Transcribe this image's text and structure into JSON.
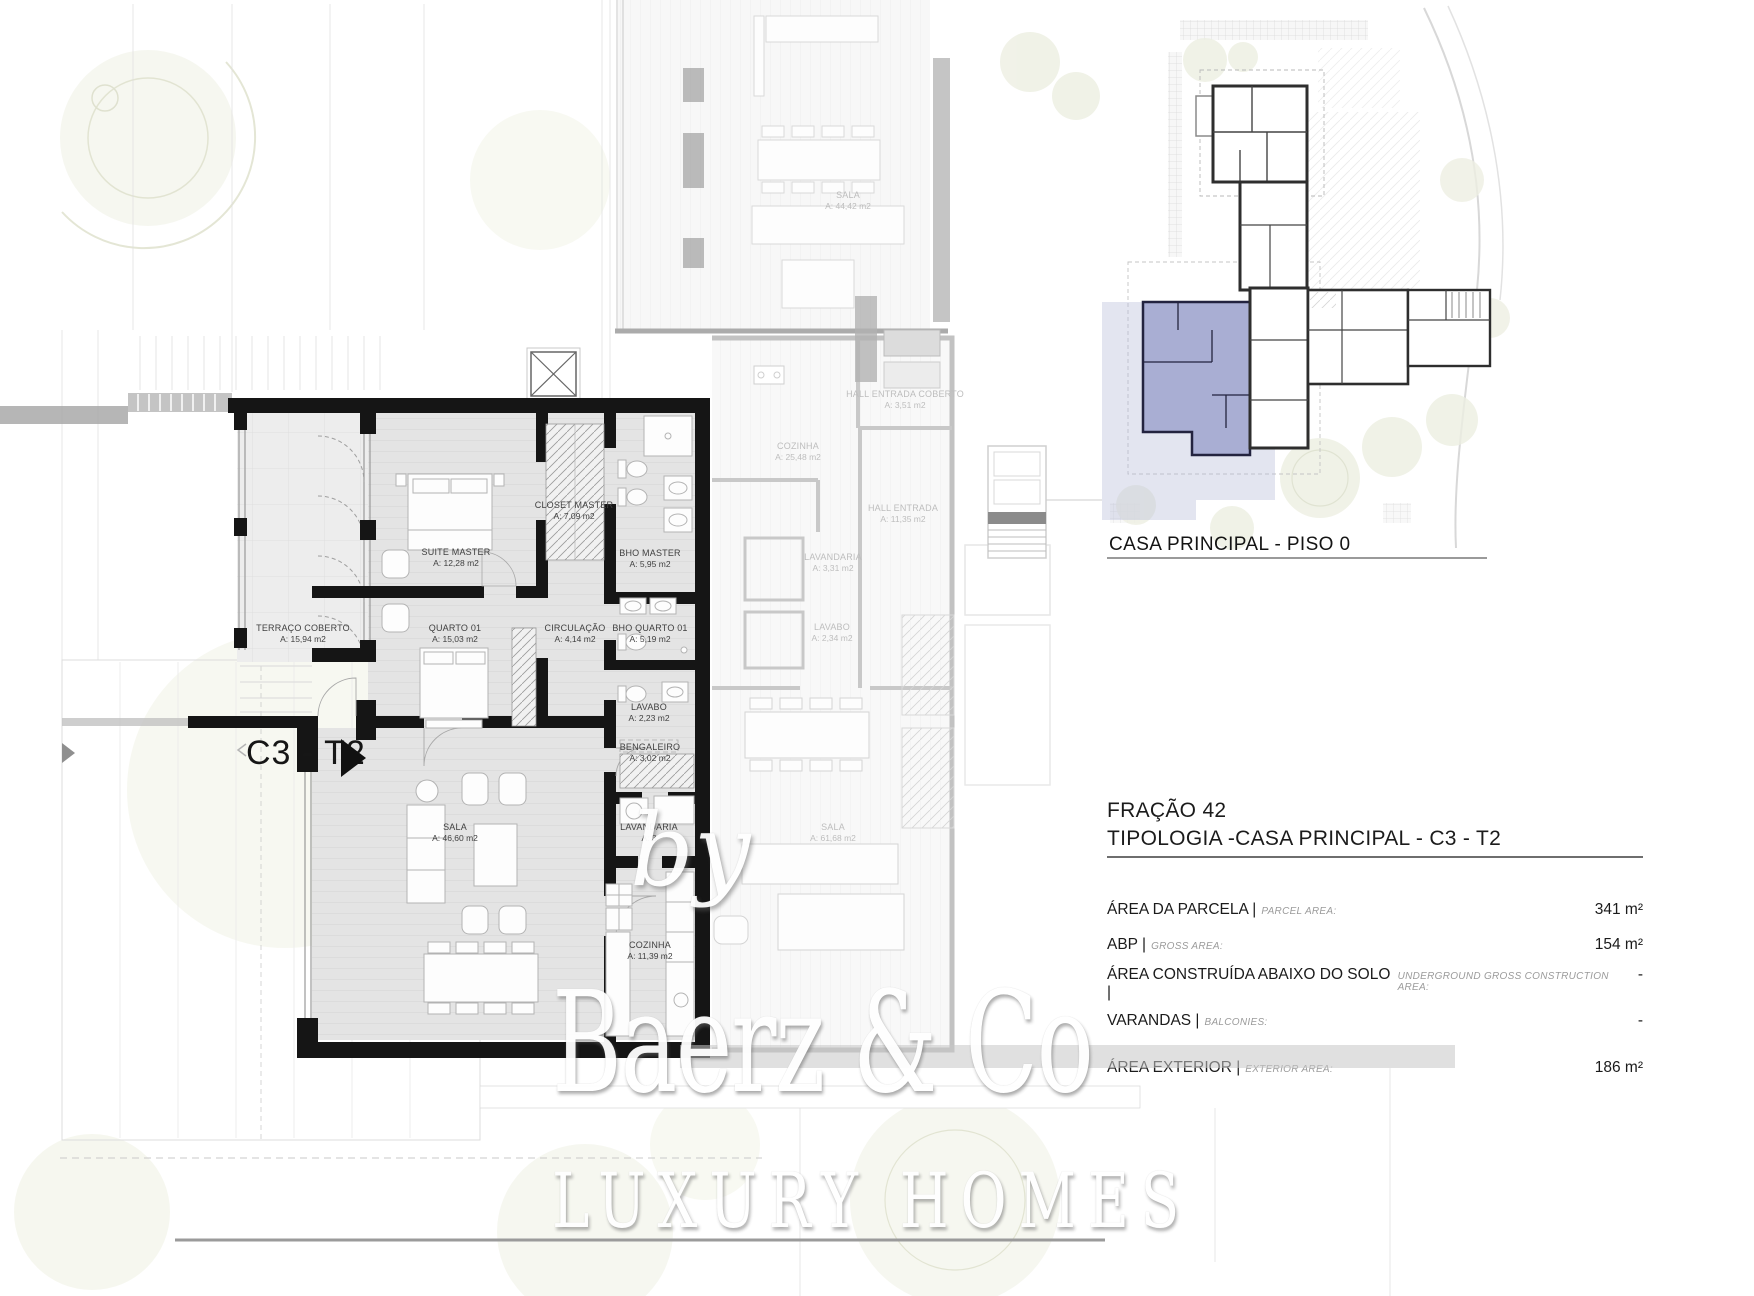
{
  "plan": {
    "unit_label": "C3 - T2",
    "rooms": [
      {
        "name": "SUITE MASTER",
        "area": "A: 12,28 m2"
      },
      {
        "name": "CLOSET MASTER",
        "area": "A: 7,09 m2"
      },
      {
        "name": "BHO MASTER",
        "area": "A: 5,95 m2"
      },
      {
        "name": "TERRAÇO COBERTO",
        "area": "A: 15,94 m2"
      },
      {
        "name": "QUARTO 01",
        "area": "A: 15,03 m2"
      },
      {
        "name": "CIRCULAÇÃO",
        "area": "A: 4,14 m2"
      },
      {
        "name": "BHO QUARTO 01",
        "area": "A: 5,19 m2"
      },
      {
        "name": "LAVABO",
        "area": "A: 2,23 m2"
      },
      {
        "name": "BENGALEIRO",
        "area": "A: 3,02 m2"
      },
      {
        "name": "SALA",
        "area": "A: 46,60 m2"
      },
      {
        "name": "LAVANDARIA",
        "area": "A: 3"
      },
      {
        "name": "COZINHA",
        "area": "A: 11,39 m2"
      }
    ],
    "context_rooms": [
      {
        "name": "SALA",
        "area": "A: 44,42 m2"
      },
      {
        "name": "COZINHA",
        "area": "A: 25,48 m2"
      },
      {
        "name": "HALL ENTRADA COBERTO",
        "area": "A: 3,51 m2"
      },
      {
        "name": "HALL ENTRADA",
        "area": "A: 11,35 m2"
      },
      {
        "name": "LAVANDARIA",
        "area": "A: 3,31 m2"
      },
      {
        "name": "LAVABO",
        "area": "A: 2,34 m2"
      },
      {
        "name": "SALA",
        "area": "A: 61,68 m2"
      }
    ],
    "wall_color": "#151515"
  },
  "key_plan": {
    "caption": "CASA PRINCIPAL - PISO 0",
    "highlight_color": "#a9aed3"
  },
  "title_block": {
    "fraction": "FRAÇÃO 42",
    "typology": "TIPOLOGIA -CASA PRINCIPAL - C3 - T2",
    "rows": [
      {
        "label": "ÁREA DA PARCELA |",
        "sublabel": "PARCEL AREA:",
        "value": "341 m²"
      },
      {
        "label": "ABP |",
        "sublabel": "GROSS AREA:",
        "value": "154 m²"
      },
      {
        "label": "ÁREA CONSTRUÍDA ABAIXO DO SOLO |",
        "sublabel": "UNDERGROUND GROSS CONSTRUCTION AREA:",
        "value": "-"
      },
      {
        "label": "VARANDAS |",
        "sublabel": "BALCONIES:",
        "value": "-"
      },
      {
        "label": "ÁREA EXTERIOR |",
        "sublabel": "EXTERIOR AREA:",
        "value": "186 m²"
      }
    ]
  },
  "watermark": {
    "prefix": "by",
    "brand": "Baerz & Co",
    "tagline": "LUXURY HOMES"
  }
}
